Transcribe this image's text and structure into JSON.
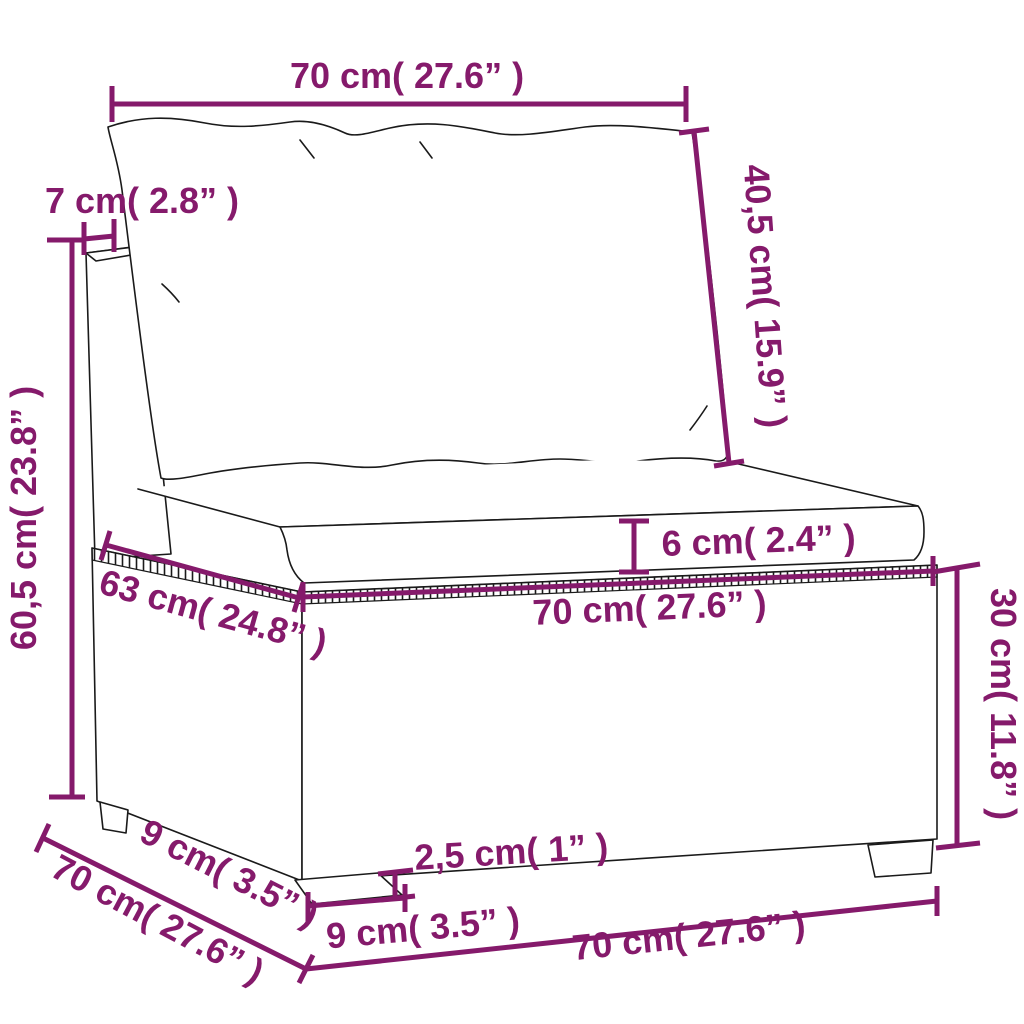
{
  "diagram_type": "furniture dimension diagram",
  "colors": {
    "dimension": "#851a6b",
    "sketch_outline": "#1a1a1a",
    "background": "#ffffff"
  },
  "dimensions": {
    "back_width": "70 cm( 27.6” )",
    "back_cushion_height": "40,5 cm( 15.9” )",
    "back_frame_thickness": "7 cm( 2.8” )",
    "back_total_height": "60,5 cm( 23.8” )",
    "seat_depth": "63 cm( 24.8” )",
    "seat_cushion_thickness": "6 cm( 2.4” )",
    "seat_width": "70 cm( 27.6” )",
    "base_height": "30 cm( 11.8” )",
    "leg_height": "2,5 cm( 1” )",
    "front_leg_width": "9 cm( 3.5” )",
    "side_leg_width": "9 cm( 3.5” )",
    "base_depth": "70 cm( 27.6” )",
    "base_width": "70 cm( 27.6” )"
  }
}
